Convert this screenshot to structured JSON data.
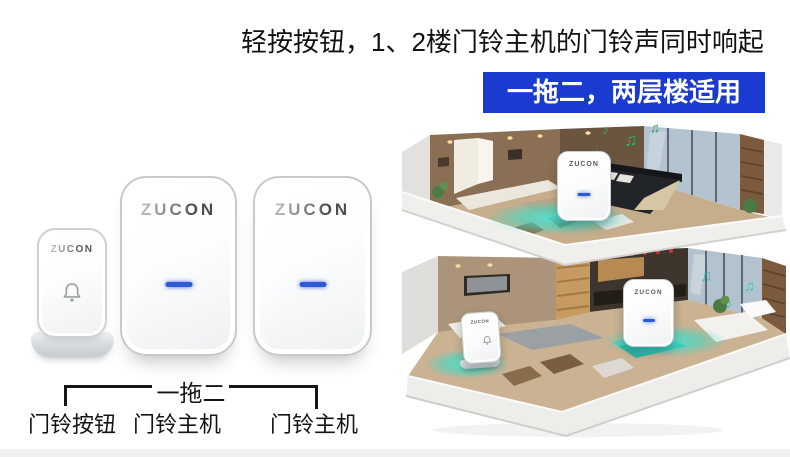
{
  "brand": "ZUCON",
  "headline": {
    "text": "轻按按钮，1、2楼门铃主机的门铃声同时响起"
  },
  "banner": {
    "text": "一拖二，两层楼适用",
    "bg": "#1a3ad0",
    "fg": "#ffffff"
  },
  "diagram": {
    "bracket_label": "一拖二",
    "items": [
      "门铃按钮",
      "门铃主机",
      "门铃主机"
    ]
  },
  "devices": {
    "led_color": "#2e5bd3",
    "glow_color": "#35dcc9"
  },
  "illustration": {
    "notes_floor2": [
      "♪",
      "♫",
      "♪",
      "♫"
    ],
    "notes_floor1": [
      "♫",
      "♪",
      "♫"
    ],
    "note_color_floor2": "#2fae62",
    "note_color_floor1": "#27c5b2"
  }
}
